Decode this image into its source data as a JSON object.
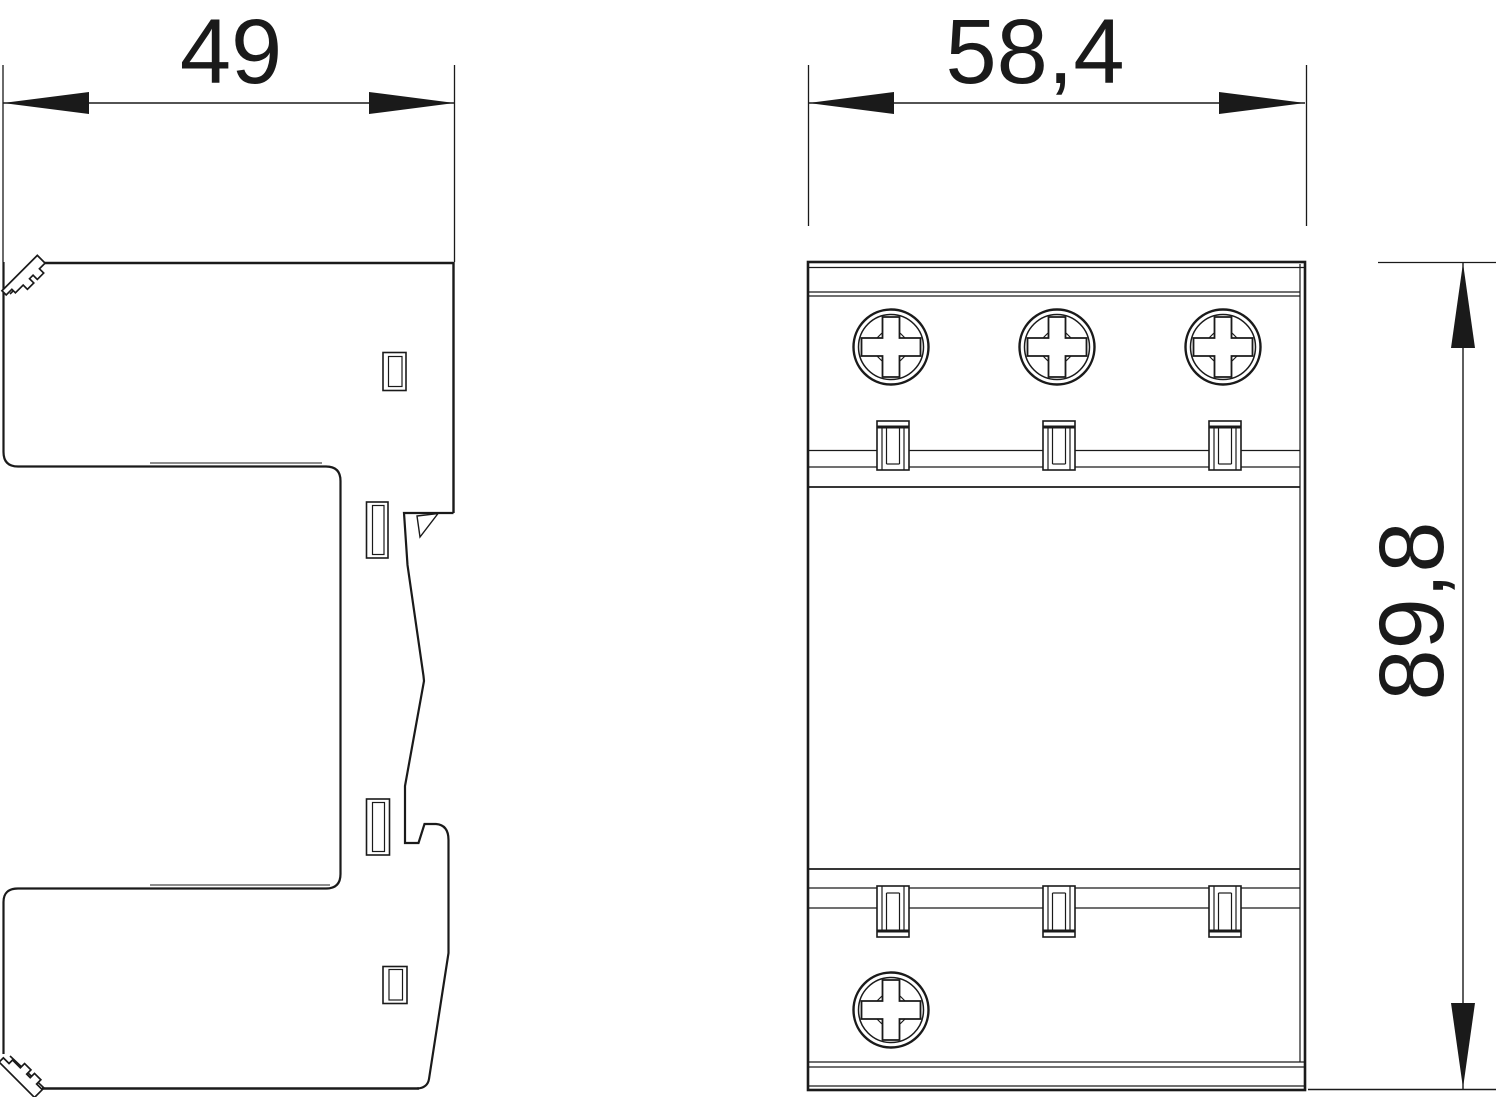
{
  "drawing": {
    "title": "surge-protection-device-dimension-drawing",
    "background_color": "#ffffff",
    "line_color": "#1a1a1a",
    "views": {
      "side": {
        "name": "side-view"
      },
      "front": {
        "name": "front-view"
      }
    },
    "dimensions": {
      "depth": {
        "label": "49",
        "view": "side",
        "orientation": "horizontal"
      },
      "width": {
        "label": "58,4",
        "view": "front",
        "orientation": "horizontal"
      },
      "height": {
        "label": "89,8",
        "view": "front",
        "orientation": "vertical"
      }
    },
    "features": {
      "front_top_screws": 3,
      "front_bottom_screws": 1,
      "front_top_latches": 3,
      "front_bottom_latches": 3,
      "side_windows": 4,
      "din_rail_clips": 2
    }
  }
}
